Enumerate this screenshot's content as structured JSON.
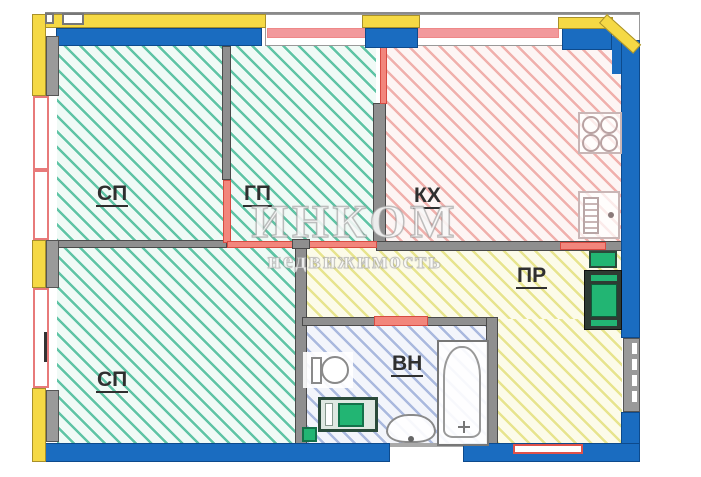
{
  "plan": {
    "watermark": {
      "brand": "ИНКОМ",
      "tagline": "недвижимость"
    },
    "rooms": {
      "sp1": {
        "label": "СП"
      },
      "gp": {
        "label": "ГП"
      },
      "kh": {
        "label": "КХ"
      },
      "sp2": {
        "label": "СП"
      },
      "vn": {
        "label": "ВН"
      },
      "pr": {
        "label": "ПР"
      }
    },
    "fixtures": [
      "stove",
      "kitchen-sink",
      "toilet",
      "washing-machine",
      "bathroom-sink",
      "bathtub",
      "hallway-cabinet"
    ],
    "colors": {
      "load_bearing_wall_blue": "#1a6cc0",
      "facade_band_yellow": "#f5d945",
      "partition_red": "#f2867c",
      "window_frame_red": "#e87a7a",
      "interior_wall_gray": "#8f8f8f",
      "hatch_green": "#5fc4a5",
      "hatch_red": "#f0b0ac",
      "hatch_yellow": "#e7e48e",
      "hatch_blue": "#aab9de",
      "appliance_green": "#22b573"
    }
  }
}
